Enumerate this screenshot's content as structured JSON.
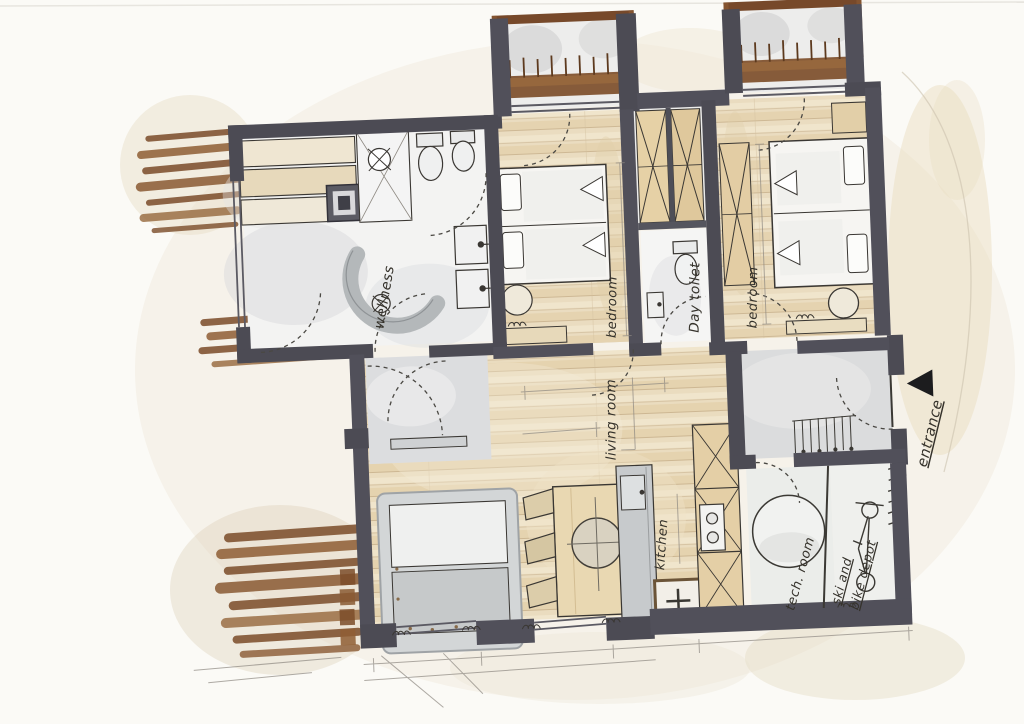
{
  "plan": {
    "rooms": [
      {
        "id": "wellness",
        "label": "wellness"
      },
      {
        "id": "bedroom-top",
        "label": "bedroom"
      },
      {
        "id": "day-toilet",
        "label": "Day toilet"
      },
      {
        "id": "bedroom-right",
        "label": "bedroom"
      },
      {
        "id": "living-room",
        "label": "living room"
      },
      {
        "id": "kitchen",
        "label": "kitchen"
      },
      {
        "id": "tech-room",
        "label": "tech. room"
      },
      {
        "id": "ski-depot",
        "label_line_1": "ski and",
        "label_line_2": "bike depot"
      }
    ],
    "entrance": {
      "label": "entrance",
      "arrow_icon": "left-filled-triangle"
    }
  },
  "palette": {
    "paper": "#fbfaf6",
    "wall": "#4c4b54",
    "ink": "#3a3733",
    "wood_floor": "#e9dabb",
    "wood_accent": "#7b4c29",
    "gray_floor": "#dcddde",
    "furniture_tan": "#e6d1a6",
    "wash_cream": "#ece4d2",
    "pencil": "#8d8881"
  }
}
